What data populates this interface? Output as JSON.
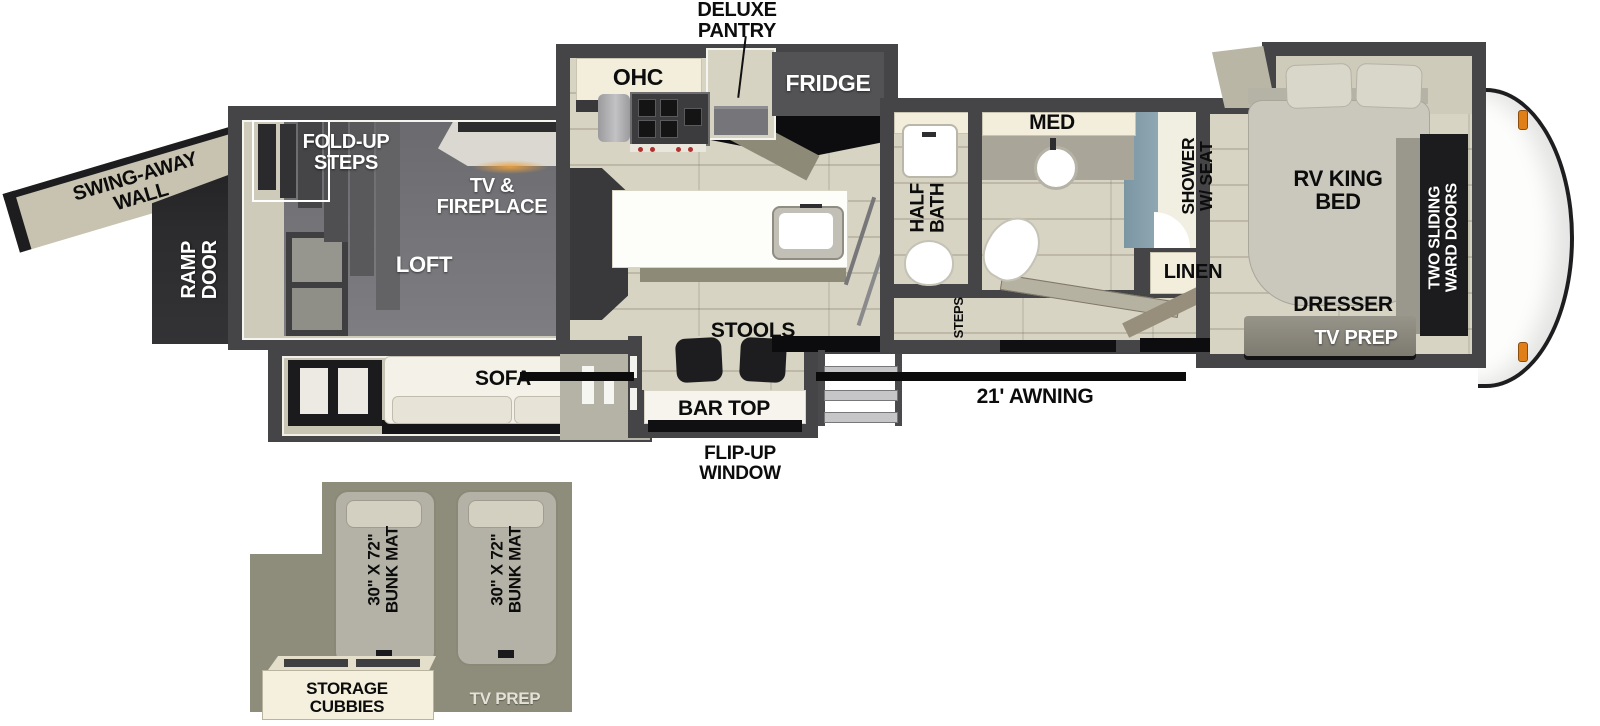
{
  "labels": {
    "deluxe_pantry": "DELUXE PANTRY",
    "ohc": "OHC",
    "fridge": "FRIDGE",
    "med": "MED",
    "shower_w_seat": "SHOWER W/ SEAT",
    "half_bath": "HALF BATH",
    "linen": "LINEN",
    "steps": "STEPS",
    "rv_king_bed": "RV KING BED",
    "two_sliding_ward_doors": "TWO SLIDING WARD DOORS",
    "dresser": "DRESSER",
    "tv_prep": "TV PREP",
    "swing_away_wall": "SWING-AWAY WALL",
    "ramp_door": "RAMP DOOR",
    "fold_up_steps": "FOLD-UP STEPS",
    "tv_fireplace": "TV & FIREPLACE",
    "loft": "LOFT",
    "sofa": "SOFA",
    "stools": "STOOLS",
    "bar_top": "BAR TOP",
    "flip_up_window": "FLIP-UP WINDOW",
    "awning": "21' AWNING"
  },
  "loft_inset": {
    "bunk_mats": [
      "30\" X 72\" BUNK MAT",
      "30\" X 72\" BUNK MAT"
    ],
    "storage_cubbies": "STORAGE CUBBIES",
    "tv_prep": "TV PREP"
  },
  "colors": {
    "wall": "#454547",
    "floor": "#d8d4c3",
    "loft_gray": "#76767a",
    "cream": "#f2eedb",
    "ramp_dark": "#29292b",
    "shower_blue": "#7f99a5",
    "clearance_light_orange": "#e07f18",
    "inset_background": "#8e8d7c",
    "awning_black": "#0b0b0b"
  }
}
